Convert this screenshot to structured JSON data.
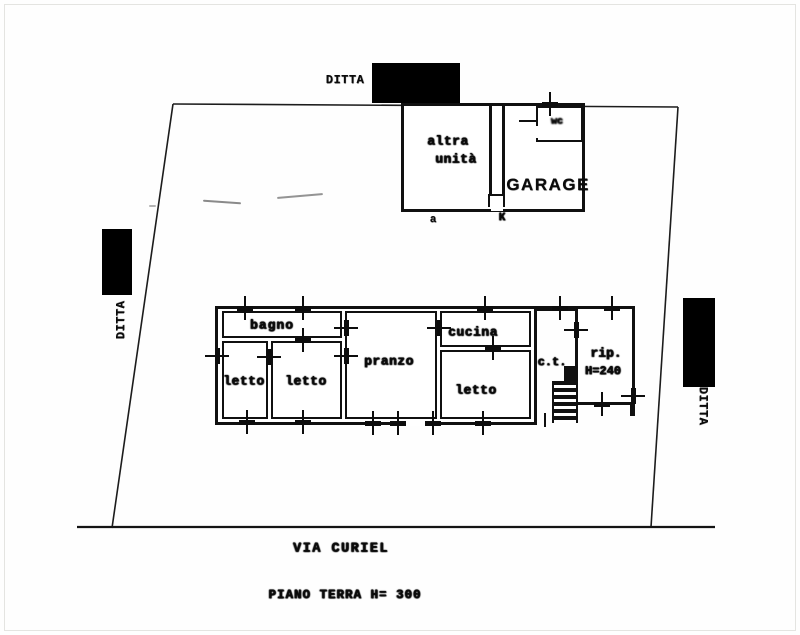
{
  "title": "Planimetria catastale - piano terra",
  "site": {
    "street_label": "VIA CURIEL",
    "caption": "PIANO TERRA H= 300",
    "owner_top": "DITTA",
    "owner_left": "DITTA",
    "owner_right": "DITTA"
  },
  "upper_building": {
    "unit_line1": "altra",
    "unit_line2": "unità",
    "garage": "GARAGE",
    "wc": "wc",
    "mark_a": "a",
    "mark_k": "K"
  },
  "main_building": {
    "bagno": "bagno",
    "letto_1": "letto",
    "letto_2": "letto",
    "letto_3": "letto",
    "pranzo": "pranzo",
    "cucina": "cucina",
    "ct": "c.t.",
    "rip": "rip.",
    "rip_height": "H=240"
  },
  "colors": {
    "ink": "#101010",
    "paper": "#fefefe",
    "redaction": "#000000"
  }
}
